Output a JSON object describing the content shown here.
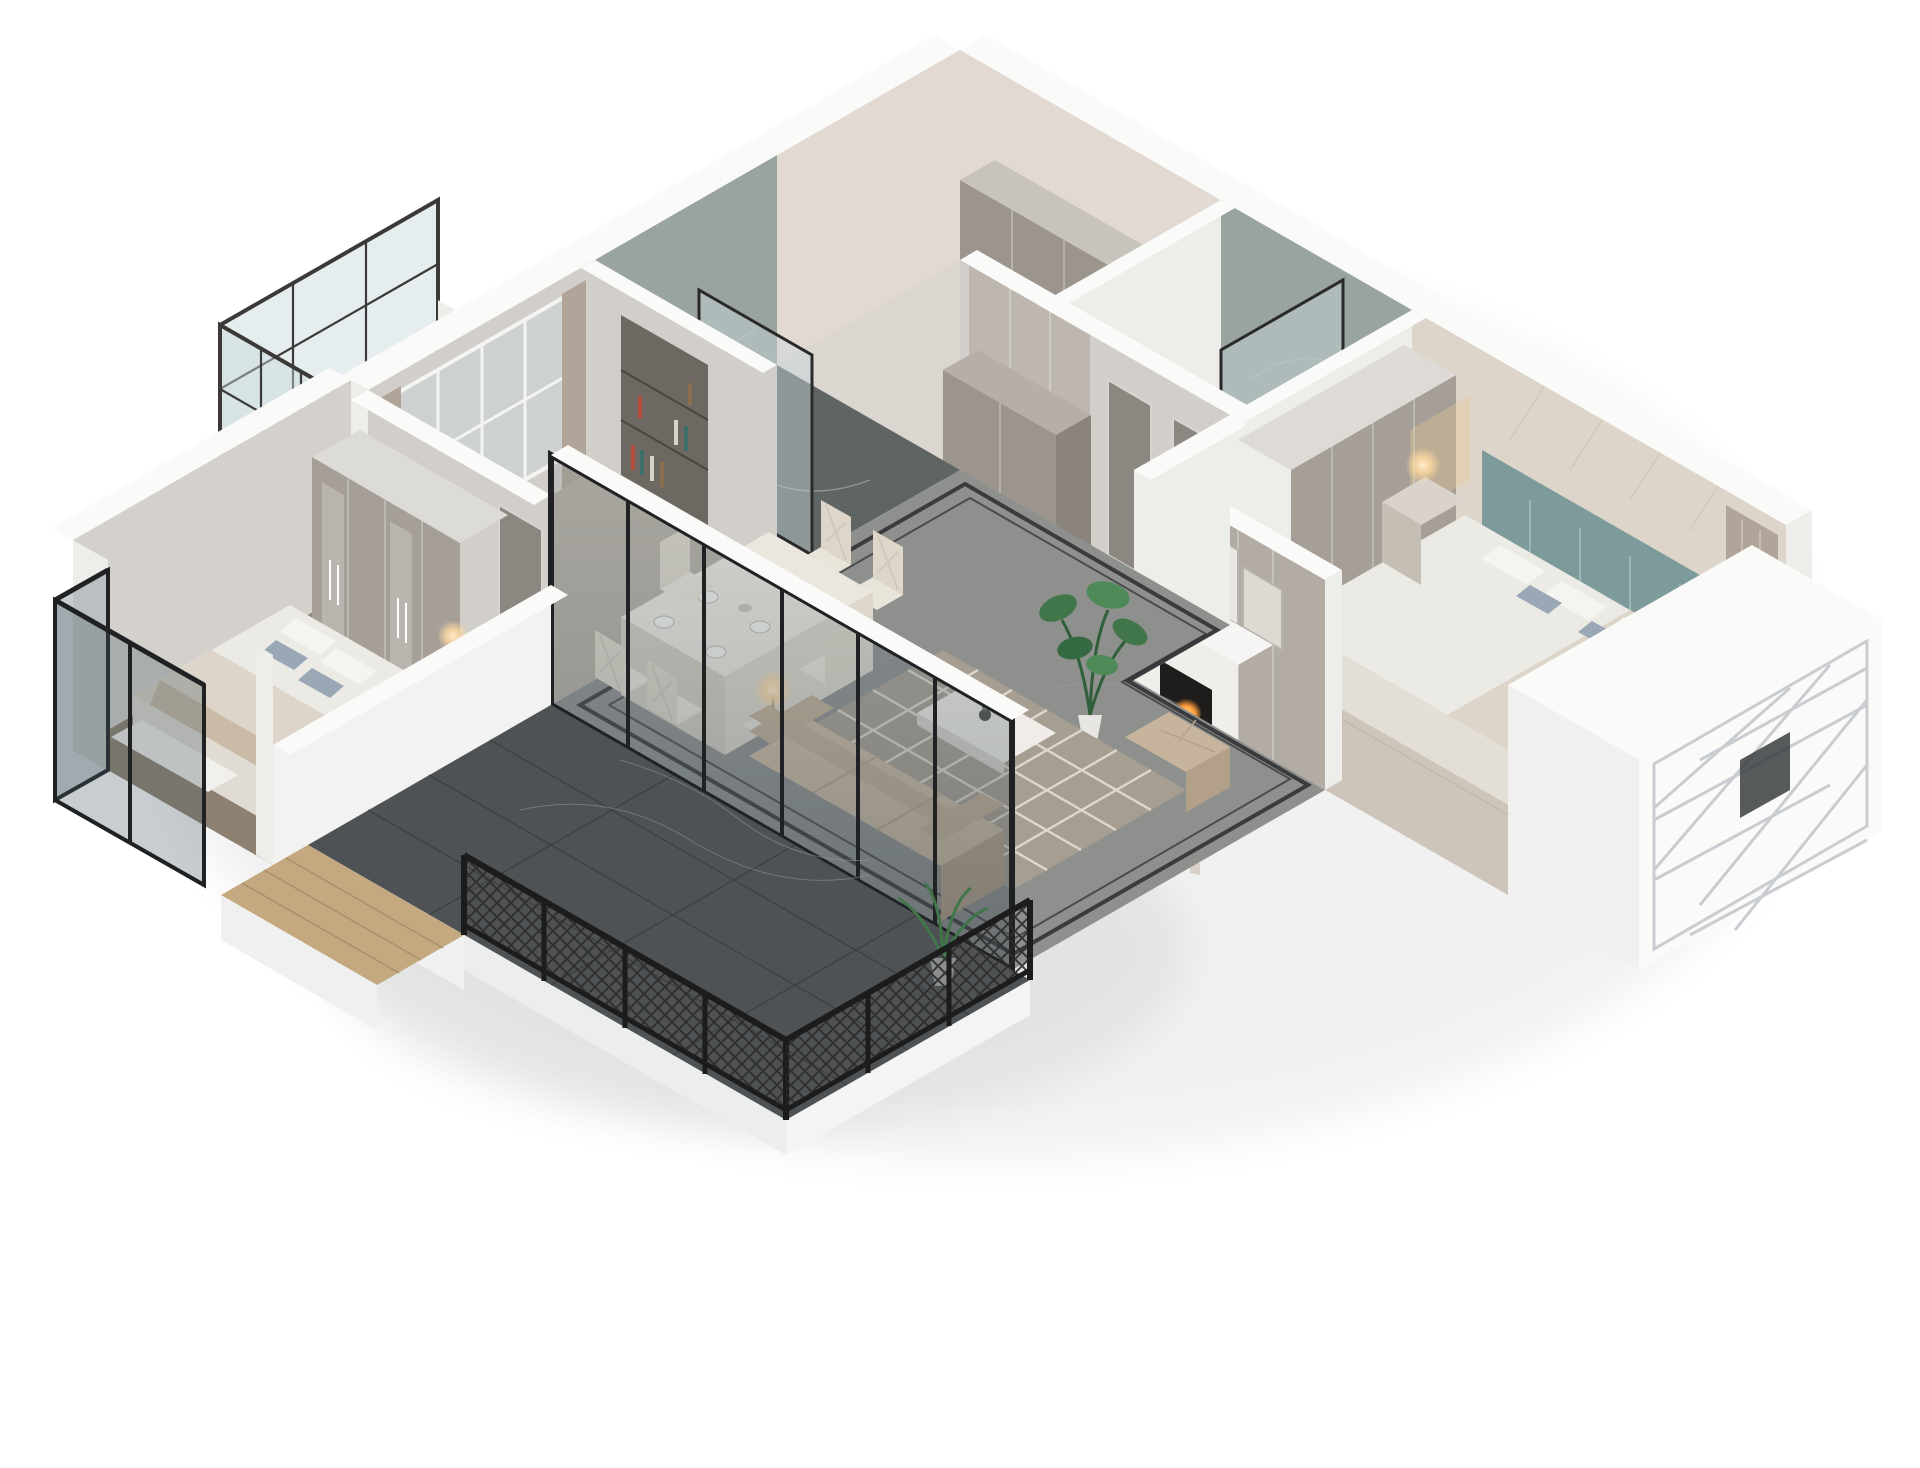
{
  "scene": {
    "type": "3d-floorplan-cutaway-render",
    "projection": "isometric-dollhouse-top-down",
    "background": "white",
    "description": "Photorealistic cutaway axonometric render of a three-bedroom apartment with white cut walls, greige interiors, dark marble living/terrace floors and black-framed glazing.",
    "rooms": [
      {
        "id": "cloak-laundry-room",
        "features": [
          "wall-cabinets",
          "curtain",
          "pink-walls"
        ]
      },
      {
        "id": "bathroom-shower",
        "features": [
          "marble-walls",
          "glass-partition"
        ]
      },
      {
        "id": "master-bedroom",
        "features": [
          "teal-headboard-bed",
          "wardrobe",
          "nightstand-lamps",
          "curtain",
          "geometric-wall-panel"
        ]
      },
      {
        "id": "bay-window-volume",
        "features": [
          "white-lattice-screen"
        ]
      },
      {
        "id": "bathroom-marble",
        "features": [
          "marble-walls",
          "glass-door",
          "dark-marble-floor"
        ]
      },
      {
        "id": "study",
        "features": [
          "window-with-curtains",
          "bookshelf"
        ]
      },
      {
        "id": "left-balcony",
        "features": [
          "lattice-screen"
        ]
      },
      {
        "id": "hallway",
        "features": [
          "gray-marble-floor",
          "black-inlay-border",
          "wall-cabinets",
          "paneled-doors"
        ]
      },
      {
        "id": "living-room",
        "features": [
          "fireplace",
          "leaning-artwork",
          "monstera-plant",
          "beige-sofa",
          "ottoman",
          "coffee-table",
          "side-table-lamp",
          "quatrefoil-rug"
        ]
      },
      {
        "id": "dining-area",
        "features": [
          "white-dining-table",
          "six-cream-chairs",
          "set-plates"
        ]
      },
      {
        "id": "glass-sliding-wall",
        "features": [
          "black-frames",
          "five-panels"
        ]
      },
      {
        "id": "terrace",
        "features": [
          "dark-marble-floor",
          "black-lattice-railing",
          "white-parapet",
          "palm-planter"
        ]
      },
      {
        "id": "second-bedroom",
        "features": [
          "glass-door-wardrobe",
          "bed-blue-pillows",
          "nightstand-lamp",
          "glass-bay-window-desk"
        ]
      },
      {
        "id": "wood-balcony",
        "features": [
          "wood-plank-floor",
          "white-parapet"
        ]
      }
    ]
  },
  "palette": {
    "bg": "#ffffff",
    "wall-top": "#fafaf9",
    "wall-face": "#ededea",
    "wall-inner": "#d2cec9",
    "wall-inner-dark": "#b3aca4",
    "pink-wall": "#e3d9d3",
    "marble-wall": "#9aa49e",
    "marble-floor-dark": "#5f6563",
    "hall-floor": "#8e908e",
    "terrace-floor": "#4e5254",
    "master-floor": "#cdc5ba",
    "study-floor": "#b6aea3",
    "bedroom2-floor": "#8f8172",
    "balcony-floor": "#c6c4c0",
    "wood-floor": "#c4a87f",
    "cabinet-gray": "#9b958e",
    "cabinet-light": "#a59f98",
    "door-gray": "#8d8782",
    "sofa-beige": "#cbb9a2",
    "sofa-mid": "#c1ae96",
    "sofa-dark": "#b3a08a",
    "rug": "#a79e92",
    "rug-pattern": "#e8e2d6",
    "bed-white": "#eceae5",
    "duvet": "#ddd5c9",
    "pillow-blue": "#9aa7b5",
    "teal-headboard": "#7d9b9b",
    "glass-tint": "rgba(70,88,98,0.30)",
    "glass-pale": "rgba(200,214,220,0.45)",
    "frame-black": "#1f2123",
    "lattice-dark": "#3c3a38",
    "fire-orange": "#ff9d3c",
    "glow-warm": "#ffd9a0",
    "plant-green": "#41764a",
    "plate-white": "#f4f2ee",
    "art-frame": "#e8e6e2",
    "vein": "#b9bdbd"
  }
}
